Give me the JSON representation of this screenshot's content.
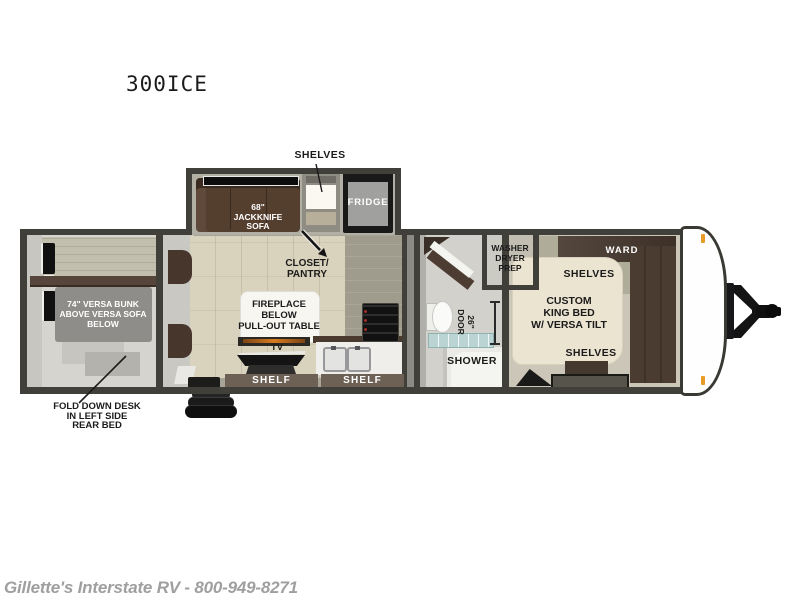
{
  "model": {
    "title": "300ICE"
  },
  "watermark": {
    "text": "Gillette's Interstate RV - 800-949-8271"
  },
  "floorplan": {
    "slideout": {
      "shelves_callout": "SHELVES",
      "sofa": "68\"\nJACKKNIFE\nSOFA",
      "fridge": "FRIDGE"
    },
    "living": {
      "closet_pantry": "CLOSET/\nPANTRY",
      "fireplace_table": "FIREPLACE\nBELOW\nPULL-OUT TABLE",
      "tv": "TV",
      "shelf_left": "SHELF",
      "shelf_right": "SHELF"
    },
    "rear_bedroom": {
      "bunk": "74\" VERSA BUNK\nABOVE VERSA SOFA\nBELOW",
      "desk_callout": "FOLD DOWN DESK\nIN LEFT SIDE\nREAR BED"
    },
    "bathroom": {
      "washer_prep": "WASHER\nDRYER\nPREP",
      "door_size": "26\"\nDOOR",
      "shower": "SHOWER"
    },
    "front_bedroom": {
      "ward": "WARD",
      "shelves_top": "SHELVES",
      "king_bed": "CUSTOM\nKING BED\nW/ VERSA TILT",
      "shelves_bottom": "SHELVES"
    }
  },
  "colors": {
    "wall": "#413f3a",
    "wood_floor": "#d9d2bc",
    "sofa_brown": "#543e2e",
    "bed_cream": "#ebe4d1",
    "wardrobe_brown": "#46382e",
    "marker_light_orange": "#e89b26",
    "watermark_gray": "#9f9f9f",
    "label_black": "#1b1b1b"
  }
}
